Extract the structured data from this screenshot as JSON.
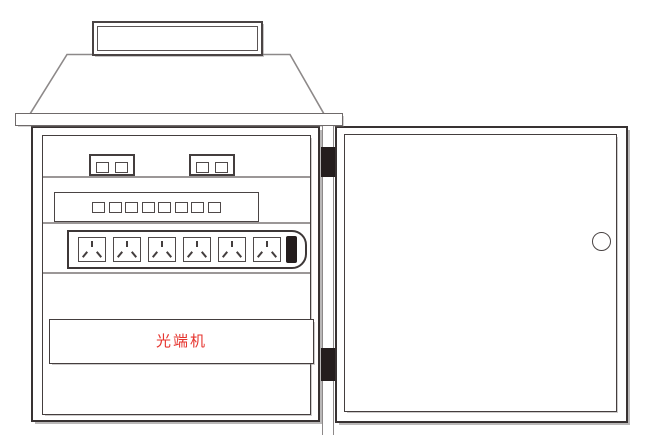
{
  "cabinet": {
    "transceiver_label": "光端机",
    "transceiver_label_color": "#e6342e",
    "module_count": 2,
    "module_indicator_count": 2,
    "switch_port_count": 8,
    "socket_count": 6,
    "power_switch_count": 1,
    "hinge_count": 2,
    "door_knob_count": 1,
    "line_color_dark": "#383232",
    "line_color_light": "#8d8989"
  }
}
